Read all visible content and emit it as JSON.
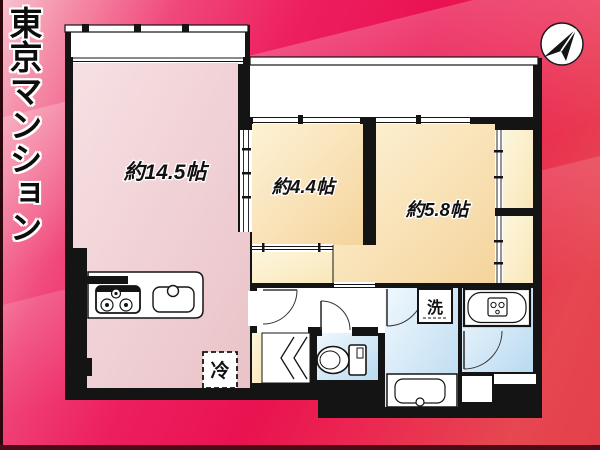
{
  "banner": {
    "title": "東京マンション"
  },
  "floorplan": {
    "rooms": [
      {
        "id": "ldk",
        "label": "約14.5帖"
      },
      {
        "id": "room-4-4",
        "label": "約4.4帖"
      },
      {
        "id": "room-5-8",
        "label": "約5.8帖"
      }
    ],
    "fixtures": {
      "refrigerator_label": "冷",
      "washing_machine_label": "洗"
    },
    "icons": {
      "compass": "north-arrow",
      "kitchen": "stove-and-sink",
      "toilet": "toilet",
      "bathroom": "bathtub",
      "washroom": "vanity-sink",
      "refrigerator": "dashed-square",
      "washing_machine": "square"
    },
    "colors": {
      "background_top": "#f8c3d0",
      "background_mid": "#ea1250",
      "background_bottom": "#e3404b",
      "wall": "#141414",
      "ldk_fill": "#f2d7da",
      "room_fill": "#fbe5b8",
      "closet_fill": "#fcf0cb",
      "wet_area_fill": "#cfe7f6",
      "balcony_fill": "#ffffff"
    }
  }
}
